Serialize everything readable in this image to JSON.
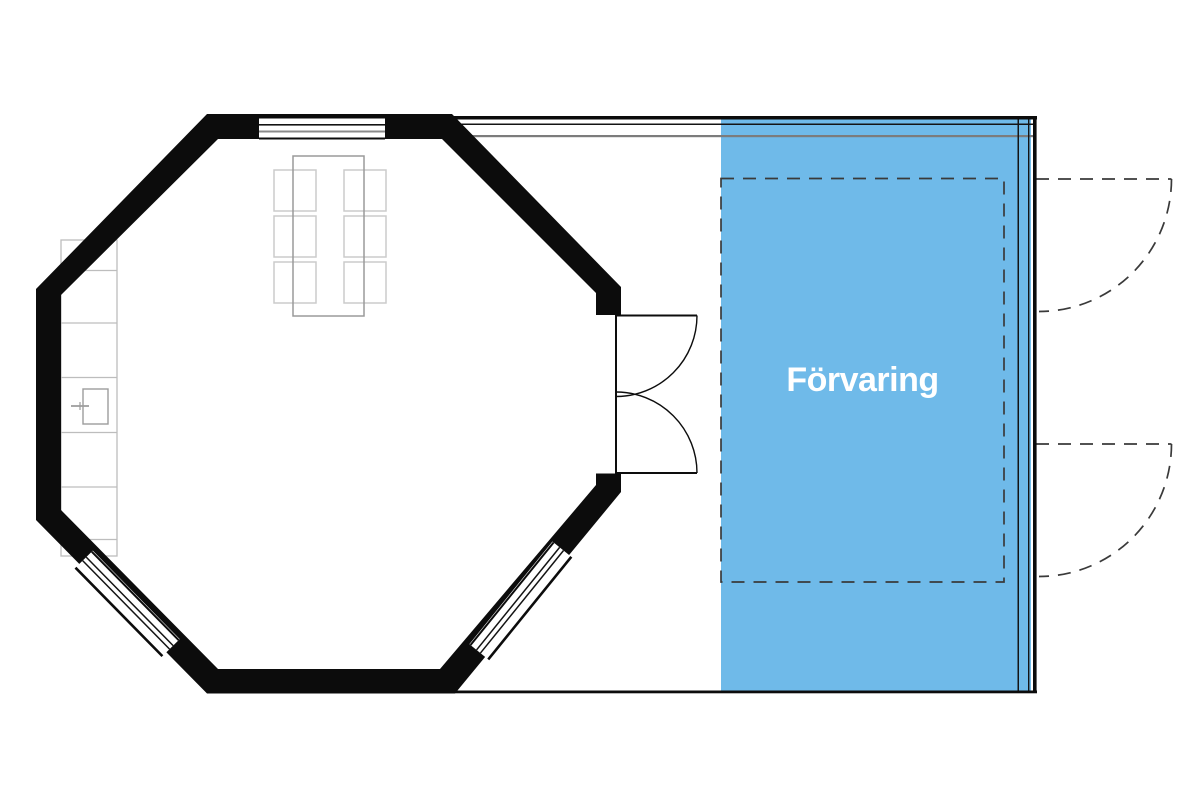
{
  "plan": {
    "storage": {
      "label": "Förvaring"
    },
    "colors": {
      "storage_fill": "#6fbae9",
      "storage_label_text": "#ffffff",
      "wall": "#0c0c0c",
      "beam_gray": "#7c7c7c",
      "dashed_line": "#3a3a3a",
      "table_outline": "#9a9a9a",
      "chair_outline": "#cbcbcb",
      "counter_outline": "#bdbdbd",
      "window_stripe_gray": "#8a8a8a"
    },
    "features": {
      "dining_chairs_count": 6,
      "windows_count": 3,
      "interior_double_door_count": 1,
      "exterior_dashed_door_count": 2
    }
  }
}
